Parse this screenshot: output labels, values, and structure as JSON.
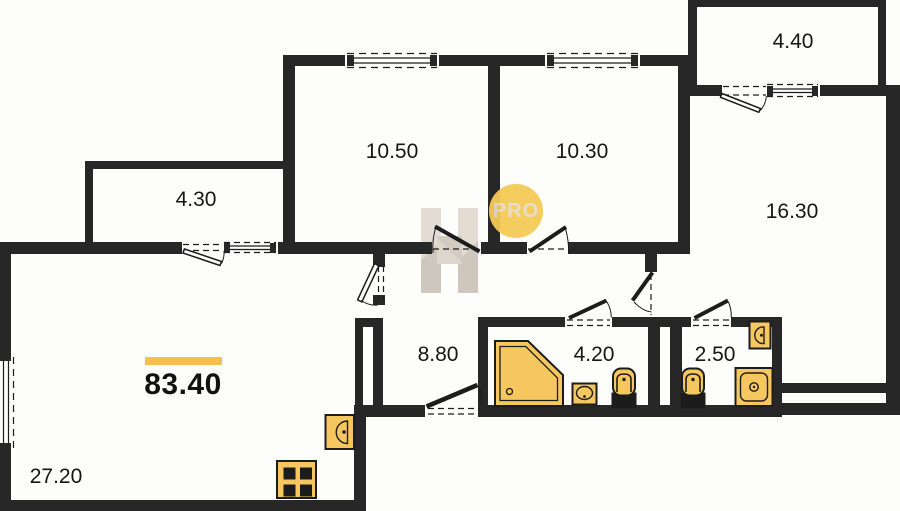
{
  "plan_title": "apartment-floor-plan",
  "total": {
    "area": "83.40"
  },
  "rooms": {
    "living": {
      "area": "27.20"
    },
    "balcony_left": {
      "area": "4.30"
    },
    "bedroom_left": {
      "area": "10.50"
    },
    "bedroom_mid": {
      "area": "10.30"
    },
    "balcony_top": {
      "area": "4.40"
    },
    "bedroom_right": {
      "area": "16.30"
    },
    "hallway": {
      "area": "8.80"
    },
    "bathroom": {
      "area": "4.20"
    },
    "wc": {
      "area": "2.50"
    }
  },
  "watermark": {
    "badge": "PRO"
  },
  "colors": {
    "wall": "#272727",
    "fixture_fill": "#f7c75f",
    "accent_bar": "#f2c14e",
    "watermark_circle": "#f5cb57"
  }
}
